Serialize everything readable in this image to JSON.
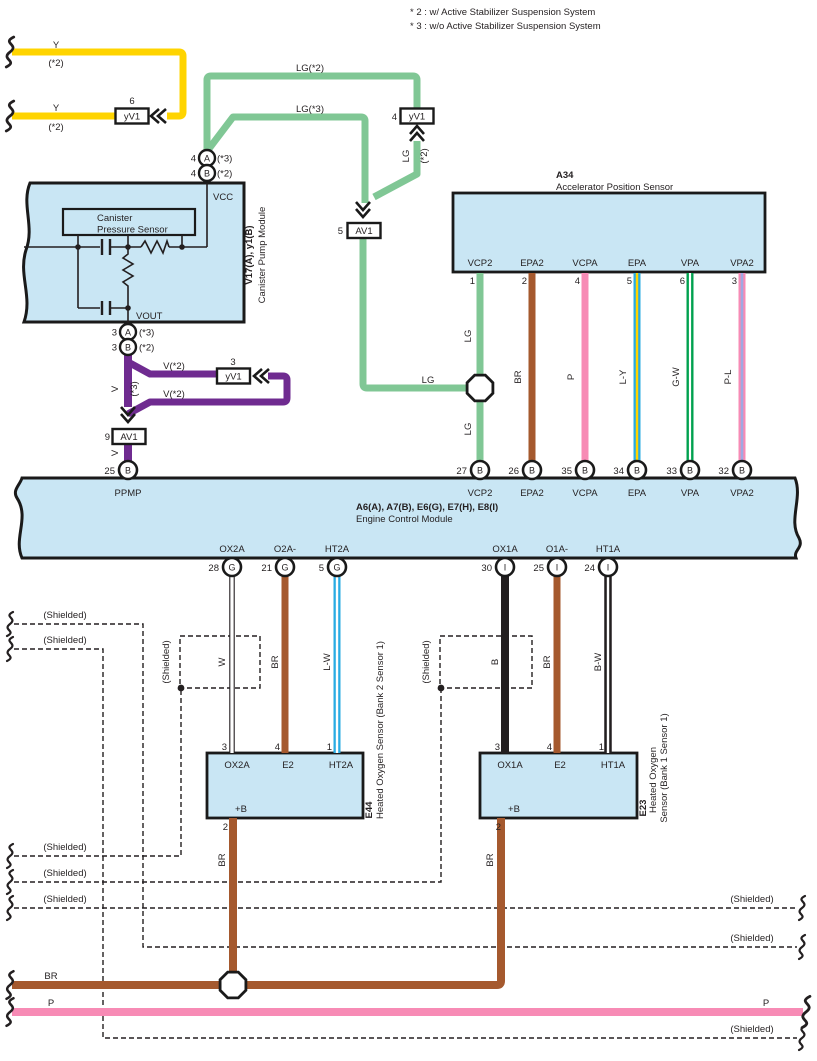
{
  "diagram": {
    "note2": "* 2 : w/ Active Stabilizer Suspension System",
    "note3": "* 3 : w/o Active Stabilizer Suspension System",
    "shielded_label": "(Shielded)"
  },
  "colors": {
    "module_fill": "#c9e6f4",
    "wire_yellow": "#ffd400",
    "wire_light_green": "#80c795",
    "wire_purple": "#6f2b90",
    "wire_brown": "#a5592e",
    "wire_pink": "#f78bb5",
    "wire_blue": "#29abe2",
    "wire_green": "#00a14f",
    "wire_pl_stripe": "#9fa9e2",
    "line_black": "#231f20"
  },
  "top_left": {
    "wire1_label": "Y",
    "wire1_note": "(*2)",
    "wire2_label": "Y",
    "wire2_note": "(*2)",
    "conn_num": "6",
    "conn_label": "yV1"
  },
  "green_section": {
    "lg2_label": "LG(*2)",
    "lg3_label": "LG(*3)",
    "conn4_num": "4",
    "conn4_label": "yV1",
    "vert_label": "LG",
    "vert_note": "(*2)",
    "conn5_num": "5",
    "conn5_label": "AV1",
    "h_label": "LG",
    "above_label": "LG",
    "below_label": "LG"
  },
  "canister_module": {
    "id": "V17(A), y1(B)",
    "name": "Canister Pump Module",
    "sensor_line1": "Canister",
    "sensor_line2": "Pressure Sensor",
    "vcc": "VCC",
    "vout": "VOUT",
    "top_conns": [
      {
        "num": "4",
        "letter": "A",
        "note": "(*3)"
      },
      {
        "num": "4",
        "letter": "B",
        "note": "(*2)"
      }
    ],
    "bottom_conns": [
      {
        "num": "3",
        "letter": "A",
        "note": "(*3)"
      },
      {
        "num": "3",
        "letter": "B",
        "note": "(*2)"
      }
    ]
  },
  "purple_section": {
    "v_label": "V",
    "v_note": "(*3)",
    "branch_top": "V(*2)",
    "branch_bottom": "V(*2)",
    "conn3_num": "3",
    "conn3_label": "yV1",
    "conn9_num": "9",
    "conn9_label": "AV1",
    "below_label": "V"
  },
  "a34": {
    "id": "A34",
    "name": "Accelerator Position Sensor",
    "pins": [
      {
        "num": "1",
        "label": "VCP2",
        "wire_color": "LG"
      },
      {
        "num": "2",
        "label": "EPA2",
        "wire_color": "BR"
      },
      {
        "num": "4",
        "label": "VCPA",
        "wire_color": "P"
      },
      {
        "num": "5",
        "label": "EPA",
        "wire_color": "L-Y"
      },
      {
        "num": "6",
        "label": "VPA",
        "wire_color": "G-W"
      },
      {
        "num": "3",
        "label": "VPA2",
        "wire_color": "P-L"
      }
    ]
  },
  "ecm": {
    "id": "A6(A), A7(B), E6(G), E7(H), E8(I)",
    "name": "Engine Control Module",
    "ppmp": {
      "num": "25",
      "letter": "B",
      "label": "PPMP"
    },
    "top_pins": [
      {
        "num": "27",
        "letter": "B",
        "label": "VCP2"
      },
      {
        "num": "26",
        "letter": "B",
        "label": "EPA2"
      },
      {
        "num": "35",
        "letter": "B",
        "label": "VCPA"
      },
      {
        "num": "34",
        "letter": "B",
        "label": "EPA"
      },
      {
        "num": "33",
        "letter": "B",
        "label": "VPA"
      },
      {
        "num": "32",
        "letter": "B",
        "label": "VPA2"
      }
    ],
    "bottom_pins": [
      {
        "num": "28",
        "letter": "G",
        "label": "OX2A",
        "wire_color": "W"
      },
      {
        "num": "21",
        "letter": "G",
        "label": "O2A-",
        "wire_color": "BR"
      },
      {
        "num": "5",
        "letter": "G",
        "label": "HT2A",
        "wire_color": "L-W"
      },
      {
        "num": "30",
        "letter": "I",
        "label": "OX1A",
        "wire_color": "B"
      },
      {
        "num": "25",
        "letter": "I",
        "label": "O1A-",
        "wire_color": "BR"
      },
      {
        "num": "24",
        "letter": "I",
        "label": "HT1A",
        "wire_color": "B-W"
      }
    ]
  },
  "e44": {
    "id": "E44",
    "name": "Heated Oxygen Sensor (Bank 2 Sensor 1)",
    "pins_top": [
      {
        "num": "3",
        "label": "OX2A"
      },
      {
        "num": "4",
        "label": "E2"
      },
      {
        "num": "1",
        "label": "HT2A"
      }
    ],
    "pin_bottom": {
      "num": "2",
      "label": "+B",
      "wire_color": "BR"
    }
  },
  "e23": {
    "id": "E23",
    "name_line1": "Heated Oxygen",
    "name_line2": "Sensor (Bank 1 Sensor 1)",
    "pins_top": [
      {
        "num": "3",
        "label": "OX1A"
      },
      {
        "num": "4",
        "label": "E2"
      },
      {
        "num": "1",
        "label": "HT1A"
      }
    ],
    "pin_bottom": {
      "num": "2",
      "label": "+B",
      "wire_color": "BR"
    }
  },
  "bottom": {
    "br_label": "BR",
    "p_label_left": "P",
    "p_label_right": "P"
  }
}
